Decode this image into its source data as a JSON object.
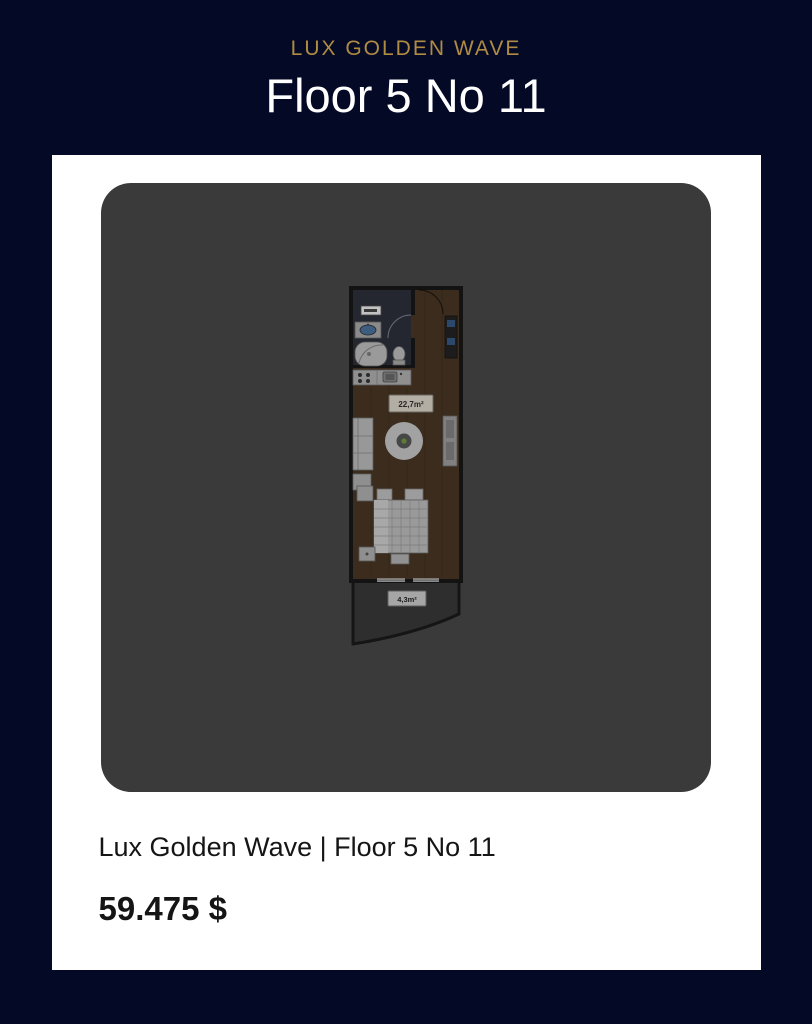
{
  "header": {
    "project_name": "LUX GOLDEN WAVE",
    "title": "Floor 5 No 11"
  },
  "card": {
    "caption": "Lux Golden Wave | Floor 5 No 11",
    "price": "59.475 $"
  },
  "floor_plan": {
    "main_area_label": "22,7m²",
    "balcony_area_label": "4,3m²"
  },
  "colors": {
    "page_background": "#040a26",
    "accent_gold": "#b08c43",
    "card_background": "#ffffff",
    "plan_panel_background": "#3a3a3a",
    "text_dark": "#151515",
    "plan_wood_floor": "#3b2c1d",
    "plan_walls": "#131313",
    "plan_balcony": "#2e2e2e"
  }
}
